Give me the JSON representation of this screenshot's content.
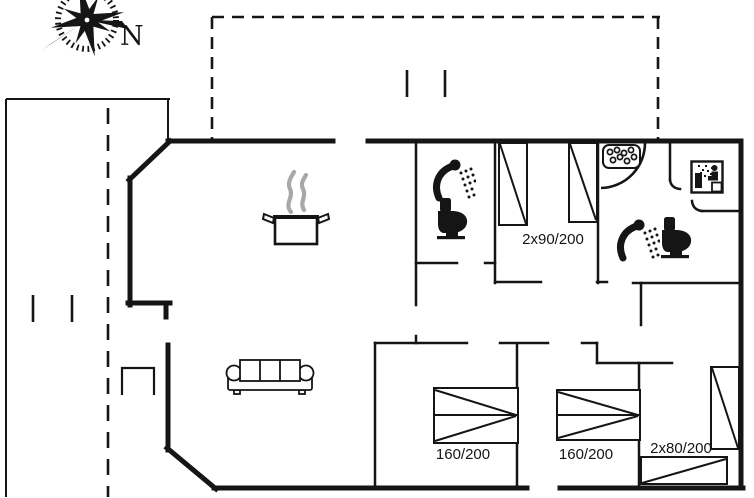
{
  "plan": {
    "colors": {
      "line": "#151515",
      "steam": "#a8a8a8",
      "background": "#ffffff"
    },
    "compass": {
      "north_label": "N"
    },
    "rooms": {
      "bedroom_top": {
        "bed_label": "2x90/200"
      },
      "bedroom_bottom_left": {
        "bed_label": "160/200"
      },
      "bedroom_bottom_middle": {
        "bed_label": "160/200"
      },
      "bedroom_bottom_right": {
        "bed_label": "2x80/200"
      }
    },
    "fixtures": [
      "compass-rose-icon",
      "steam-pot-icon",
      "shower-icon",
      "toilet-icon",
      "whirlpool-icon",
      "sauna-icon",
      "sofa-icon",
      "chair-icon",
      "bed-symbol",
      "terrace-dashed-outline",
      "carport-dashed-outline"
    ]
  }
}
